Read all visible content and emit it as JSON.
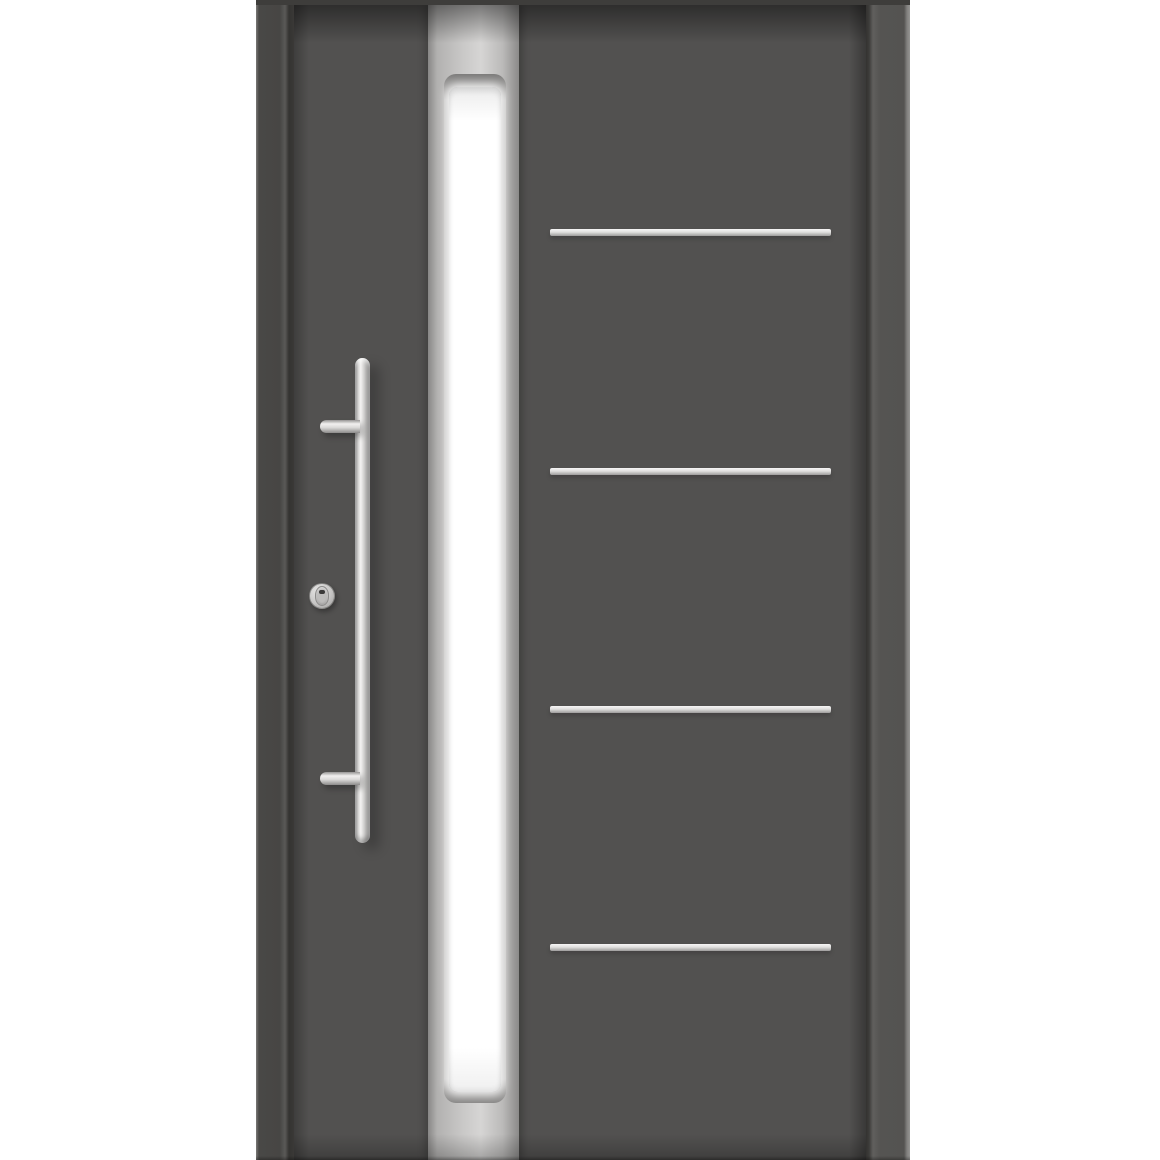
{
  "image": {
    "type": "product-photo",
    "subject": "Modern anthracite grey front entry door with stainless steel bar pull handle, full-height vertical frosted glass strip and four horizontal stainless steel decorative inlays",
    "background_color": "#ffffff",
    "visible_text": []
  },
  "door": {
    "style": "contemporary aluminium entry door",
    "colors": {
      "leaf": "#525150",
      "frame_left": "#494846",
      "frame_right": "#555452",
      "frame_top": "#3e3d3b",
      "steel_light": "#d6d5d4",
      "steel_dark": "#9d9c9b",
      "glass": "#ffffff",
      "shadow": "#3a3938"
    },
    "glazing": {
      "description": "vertical stainless-framed frosted glass strip, rounded recess, runs nearly full door height",
      "count": 1
    },
    "decor_strips": {
      "description": "horizontal brushed stainless inlays on right half of leaf",
      "count": 4,
      "tops_leaf_px": [
        224,
        463,
        701,
        939
      ]
    },
    "handle": {
      "description": "round stainless bar pull handle with two standoff brackets",
      "brackets": 2
    },
    "lock": {
      "description": "round security escutcheon with keyhole"
    }
  }
}
